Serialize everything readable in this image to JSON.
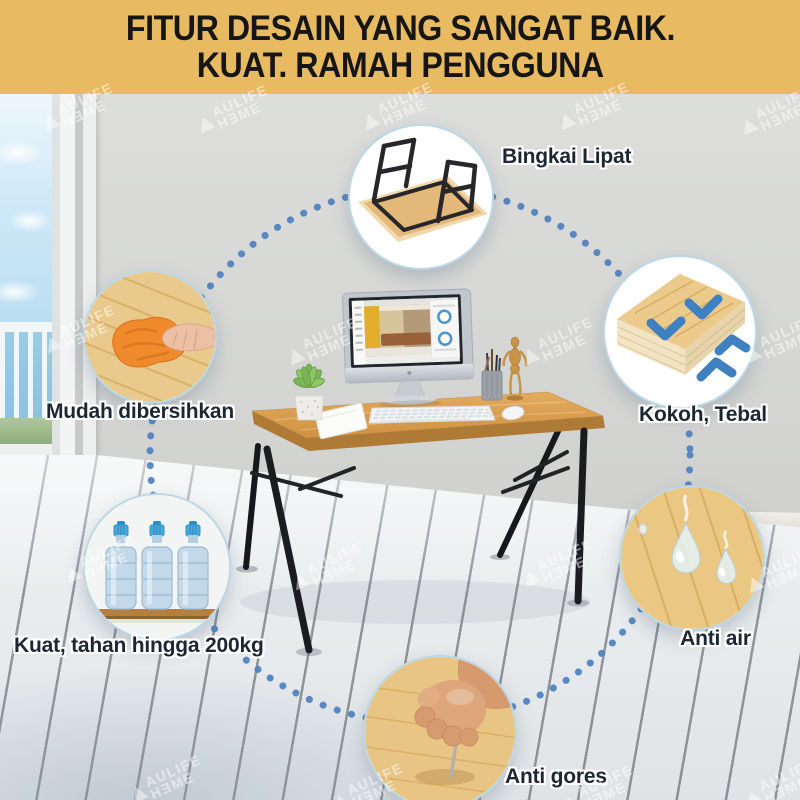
{
  "banner": {
    "line1": "FITUR DESAIN YANG SANGAT BAIK.",
    "line2": "KUAT. RAMAH PENGGUNA"
  },
  "watermark": {
    "top": "AULIFE",
    "bottom": "HƎME"
  },
  "features": [
    {
      "id": "bingkai-lipat",
      "label": "Bingkai Lipat"
    },
    {
      "id": "kokoh-tebal",
      "label": "Kokoh, Tebal"
    },
    {
      "id": "anti-air",
      "label": "Anti air"
    },
    {
      "id": "anti-gores",
      "label": "Anti gores"
    },
    {
      "id": "kuat-200kg",
      "label": "Kuat, tahan hingga 200kg"
    },
    {
      "id": "mudah-dibersihkan",
      "label": "Mudah dibersihkan"
    }
  ],
  "colors": {
    "banner_bg": "#e8bb63",
    "banner_text": "#161616",
    "dot_blue": "#4d80bf",
    "arrow_blue": "#3f80c2",
    "label_text": "#1d2733",
    "table_wood": "#d89e52"
  }
}
